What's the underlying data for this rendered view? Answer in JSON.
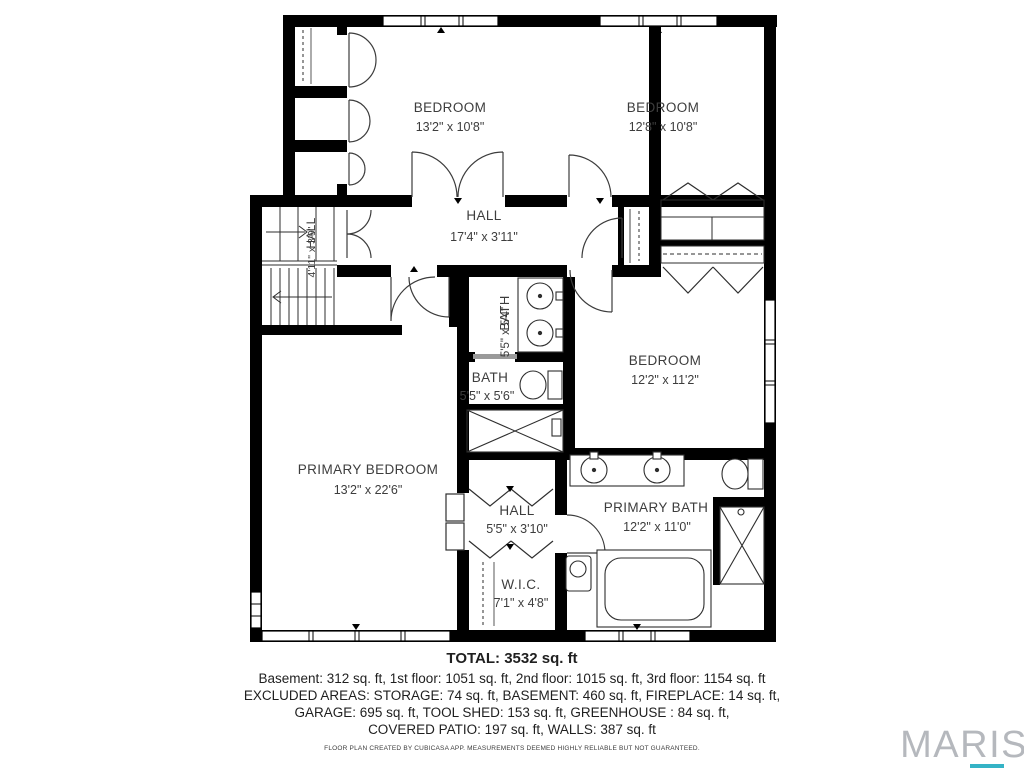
{
  "plan": {
    "rooms": [
      {
        "name": "BEDROOM",
        "dims": "13'2\" x 10'8\""
      },
      {
        "name": "BEDROOM",
        "dims": "12'8\" x 10'8\""
      },
      {
        "name": "HALL",
        "dims": "17'4\" x 3'11\""
      },
      {
        "name": "HALL",
        "dims": "4'11\" x 3'9\""
      },
      {
        "name": "BATH",
        "dims": "5'5\" x 5'4\""
      },
      {
        "name": "BATH",
        "dims": "5'5\" x 5'6\""
      },
      {
        "name": "BEDROOM",
        "dims": "12'2\" x 11'2\""
      },
      {
        "name": "PRIMARY BEDROOM",
        "dims": "13'2\" x 22'6\""
      },
      {
        "name": "HALL",
        "dims": "5'5\" x 3'10\""
      },
      {
        "name": "PRIMARY BATH",
        "dims": "12'2\" x 11'0\""
      },
      {
        "name": "W.I.C.",
        "dims": "7'1\" x 4'8\""
      }
    ]
  },
  "summary": {
    "total": "TOTAL: 3532 sq. ft",
    "line1": "Basement: 312 sq. ft, 1st floor: 1051 sq. ft, 2nd floor: 1015 sq. ft, 3rd floor: 1154 sq. ft",
    "line2": "EXCLUDED AREAS: STORAGE: 74 sq. ft, BASEMENT: 460 sq. ft, FIREPLACE: 14 sq. ft,",
    "line3": "GARAGE: 695 sq. ft, TOOL SHED: 153 sq. ft, GREENHOUSE : 84 sq. ft,",
    "line4": "COVERED PATIO: 197 sq. ft, WALLS: 387 sq. ft"
  },
  "footer": {
    "attribution": "FLOOR PLAN CREATED BY CUBICASA APP. MEASUREMENTS DEEMED HIGHLY RELIABLE BUT NOT GUARANTEED.",
    "brand": "MARIS"
  },
  "colors": {
    "wall": "#000000",
    "label": "#3d3d3d",
    "brand_gray": "#b5b8bd",
    "accent_teal": "#35b3c6"
  }
}
